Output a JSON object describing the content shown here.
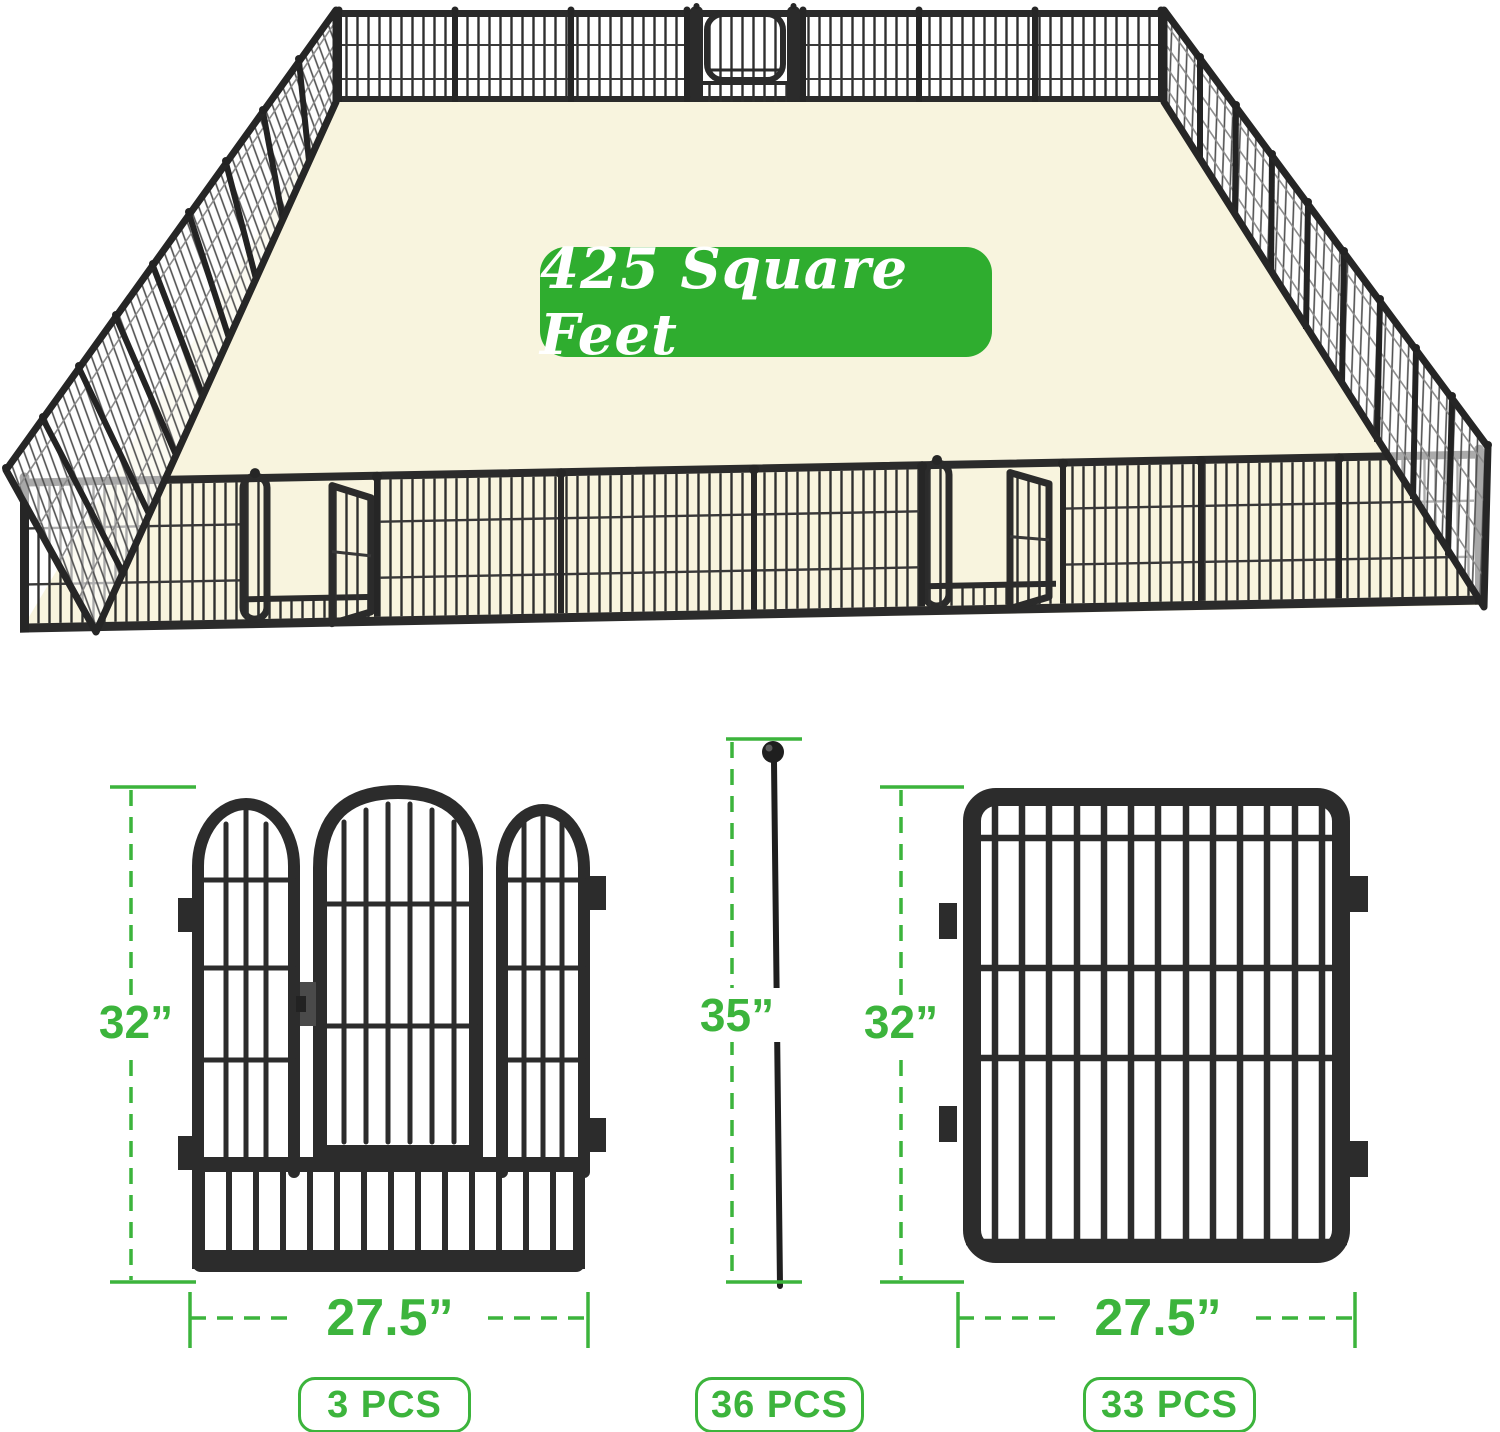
{
  "banner": {
    "area_label": "425 Square Feet"
  },
  "colors": {
    "banner_green": "#2fad2f",
    "dimension_green": "#3cb43c",
    "floor_cream": "#f8f4de",
    "fence_black": "#2c2c2c"
  },
  "items": {
    "gate_panel": {
      "height": "32”",
      "width": "27.5”",
      "count": "3 PCS"
    },
    "ground_stake": {
      "height": "35”",
      "count": "36 PCS"
    },
    "fence_panel": {
      "height": "32”",
      "width": "27.5”",
      "count": "33 PCS"
    }
  }
}
